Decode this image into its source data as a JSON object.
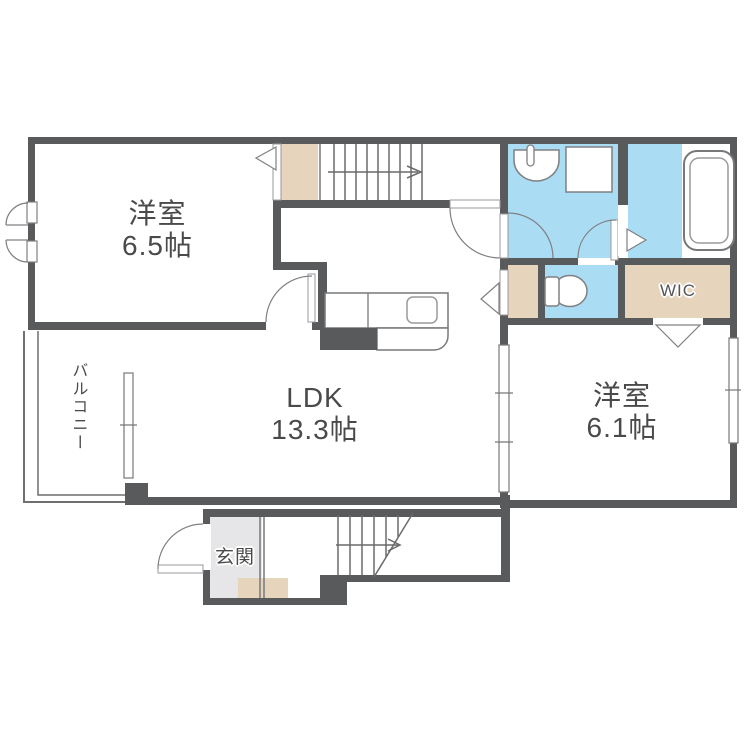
{
  "plan": {
    "rooms": {
      "bedroom_a": {
        "name": "洋室",
        "size": "6.5帖"
      },
      "ldk": {
        "name": "LDK",
        "size": "13.3帖"
      },
      "bedroom_b": {
        "name": "洋室",
        "size": "6.1帖"
      },
      "wic": {
        "name": "WIC"
      },
      "balcony": {
        "name": "バルコニー"
      },
      "entrance": {
        "name": "玄関"
      }
    },
    "fixtures": [
      "bathtub",
      "washbasin",
      "washing-machine-pan",
      "toilet",
      "kitchen-counter",
      "kitchen-sink",
      "staircase-upper",
      "staircase-lower"
    ],
    "colors": {
      "wall": "#595a5c",
      "wet_area_floor": "#aadcf4",
      "closet_floor": "#e7d4bc",
      "entrance_floor": "#e6e6e8",
      "fixture_line": "#808083",
      "text": "#4a4a4b",
      "background": "#ffffff"
    }
  }
}
